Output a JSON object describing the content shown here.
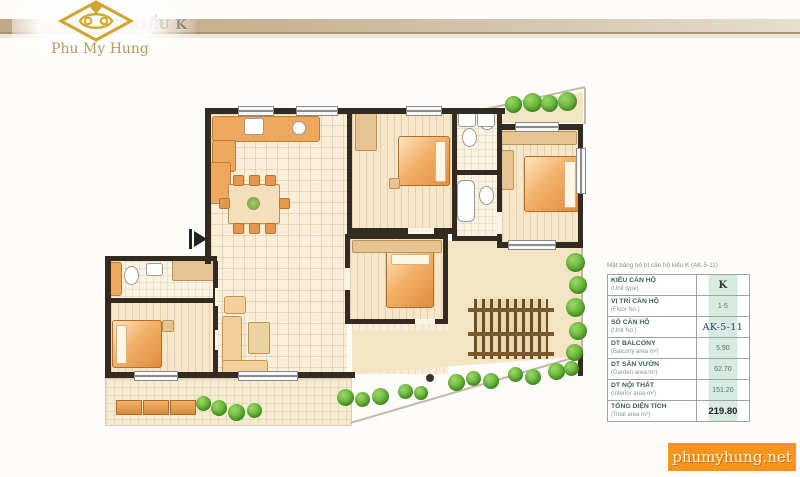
{
  "header": {
    "logo_text": "Phu My Hung",
    "title": "CĂN HỘ KIỂU K"
  },
  "info_panel": {
    "caption": "Mặt bằng bố trí căn hộ kiểu K (AK-5-11)",
    "rows": [
      {
        "label": "KIỂU CĂN HỘ",
        "sublabel": "(Unit type)",
        "value": "K"
      },
      {
        "label": "VỊ TRÍ CĂN HỘ",
        "sublabel": "(Floor No.)",
        "value": "1-5"
      },
      {
        "label": "SỐ CĂN HỘ",
        "sublabel": "(Unit No.)",
        "value": "AK-5-11"
      },
      {
        "label": "DT BALCONY",
        "sublabel": "(Balcony area m²)",
        "value": "5.90"
      },
      {
        "label": "DT SÂN VƯỜN",
        "sublabel": "(Garden area m²)",
        "value": "62.70"
      },
      {
        "label": "DT NỘI THẤT",
        "sublabel": "(Interior area m²)",
        "value": "151.20"
      },
      {
        "label": "TỔNG DIỆN TÍCH",
        "sublabel": "(Total area m²)",
        "value": "219.80"
      }
    ]
  },
  "watermark": {
    "text": "phumyhung.net",
    "bg": "#f7941d"
  },
  "colors": {
    "header_bar": "#c9b494",
    "title_text": "#45331f",
    "wall": "#332a22",
    "floor_tile": "#f8efdb",
    "floor_wood": "#f6e6ca",
    "garden": "#f3e5c3",
    "furniture_orange": "#eda75f",
    "bush_green": "#5aaa2e",
    "pergola_brown": "#7a5a2c",
    "table_accent": "#d8ebe3",
    "table_label_text": "#3c6152",
    "unit_no_text": "#223a63",
    "watermark_bg": "#f7941d",
    "watermark_text": "#fdf6d8",
    "logo_gold": "#c9a43c"
  }
}
